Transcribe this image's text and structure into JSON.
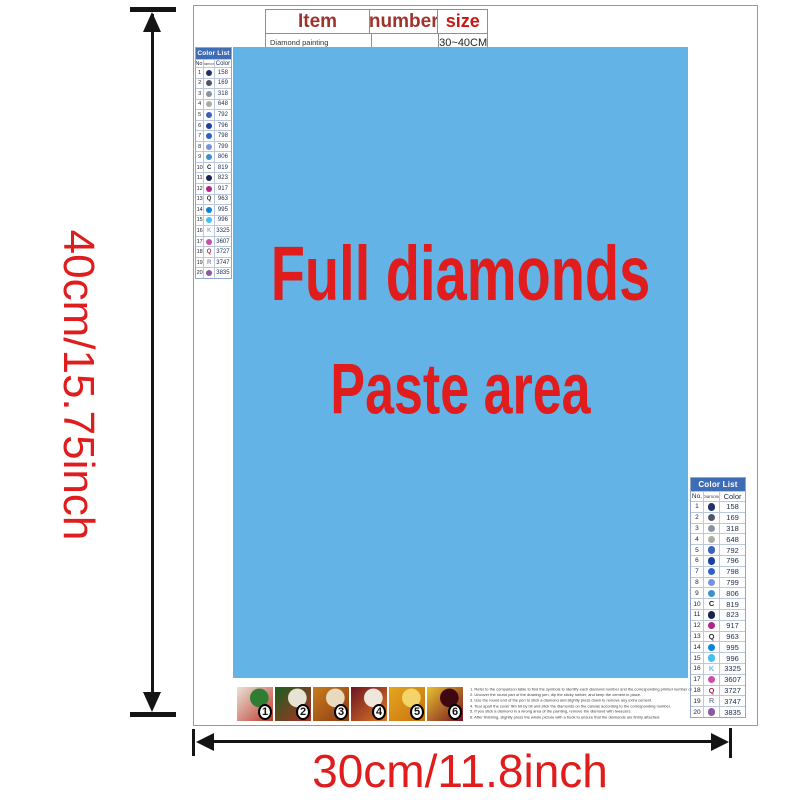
{
  "item_table": {
    "headers": [
      "Item",
      "number",
      "size"
    ],
    "row": [
      "Diamond painting",
      "",
      "30~40CM"
    ]
  },
  "dimensions": {
    "height_label": "40cm/15.75inch",
    "width_label": "30cm/11.8inch"
  },
  "paste_area": {
    "line1": "Full diamonds",
    "line2": "Paste area",
    "bg_color": "#63b3e6",
    "text_color": "#e01c1c"
  },
  "color_list": {
    "title": "Color List",
    "columns": [
      "No.",
      "Diamond",
      "Color"
    ],
    "header_bg": "#3f6db5",
    "rows": [
      {
        "no": "1",
        "type": "dot",
        "glyph": "",
        "color": "#23306b",
        "code": "158"
      },
      {
        "no": "2",
        "type": "dot",
        "glyph": "",
        "color": "#4d5568",
        "code": "169"
      },
      {
        "no": "3",
        "type": "dot",
        "glyph": "",
        "color": "#8a93a0",
        "code": "318"
      },
      {
        "no": "4",
        "type": "dot",
        "glyph": "",
        "color": "#a9ada2",
        "code": "648"
      },
      {
        "no": "5",
        "type": "dot",
        "glyph": "",
        "color": "#3c5fc0",
        "code": "792"
      },
      {
        "no": "6",
        "type": "dot",
        "glyph": "",
        "color": "#1d3f9e",
        "code": "796"
      },
      {
        "no": "7",
        "type": "dot",
        "glyph": "",
        "color": "#2f5fc4",
        "code": "798"
      },
      {
        "no": "8",
        "type": "dot",
        "glyph": "",
        "color": "#7495dd",
        "code": "799"
      },
      {
        "no": "9",
        "type": "dot",
        "glyph": "",
        "color": "#3e8fc9",
        "code": "806"
      },
      {
        "no": "10",
        "type": "letter",
        "glyph": "C",
        "color": "#222222",
        "code": "819"
      },
      {
        "no": "11",
        "type": "dot",
        "glyph": "",
        "color": "#1a2450",
        "code": "823"
      },
      {
        "no": "12",
        "type": "dot",
        "glyph": "",
        "color": "#b02585",
        "code": "917"
      },
      {
        "no": "13",
        "type": "letter",
        "glyph": "Q",
        "color": "#333333",
        "code": "963"
      },
      {
        "no": "14",
        "type": "dot",
        "glyph": "",
        "color": "#0a85d9",
        "code": "995"
      },
      {
        "no": "15",
        "type": "dot",
        "glyph": "",
        "color": "#45c0f0",
        "code": "996"
      },
      {
        "no": "16",
        "type": "letter",
        "glyph": "K",
        "color": "#7fb3e0",
        "code": "3325"
      },
      {
        "no": "17",
        "type": "dot",
        "glyph": "",
        "color": "#c84fa8",
        "code": "3607"
      },
      {
        "no": "18",
        "type": "letter",
        "glyph": "Q",
        "color": "#a03050",
        "code": "3727"
      },
      {
        "no": "19",
        "type": "letter",
        "glyph": "R",
        "color": "#9090a8",
        "code": "3747"
      },
      {
        "no": "20",
        "type": "dot",
        "glyph": "",
        "color": "#8a5a9e",
        "code": "3835"
      }
    ]
  },
  "steps": {
    "badges": [
      "1",
      "2",
      "3",
      "4",
      "5",
      "6"
    ],
    "swatches": [
      [
        "#e8e4da",
        "#c0392b",
        "#2e7d32"
      ],
      [
        "#1b5e20",
        "#b03024",
        "#e6e2d4"
      ],
      [
        "#c77d1e",
        "#8d3a12",
        "#e9d9be"
      ],
      [
        "#6d1321",
        "#e07b28",
        "#efe6dc"
      ],
      [
        "#e6a51f",
        "#c9720e",
        "#f4d468"
      ],
      [
        "#e8c22f",
        "#77121f",
        "#3f0810"
      ]
    ],
    "instructions": [
      "1. Refer to the comparison table to find the symbols to identify each diamond number and the corresponding printed number on the canvas.",
      "2. Uncover the round part of the drawing pen, dip the sticky rubber, and keep the cement in place.",
      "3. Use the round end of the pen to stick a diamond and slightly press down to remove any extra cement.",
      "4. Tear apart the cover film bit by bit and stick the diamonds on the canvas according to the corresponding number.",
      "5. If you stick a diamond in a wrong area of the painting, remove the diamond with tweezers.",
      "6. After finishing, slightly press the whole picture with a book to ensure that the diamonds are firmly attached."
    ]
  }
}
